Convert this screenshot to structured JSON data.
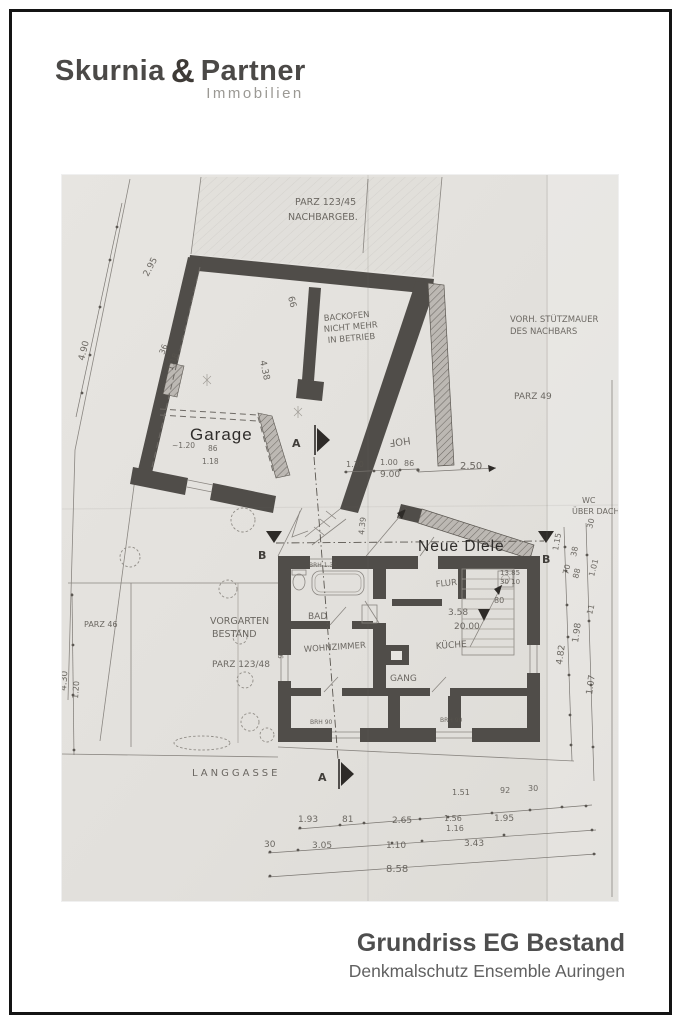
{
  "logo": {
    "name1": "Skurnia",
    "ampersand": "&",
    "name2": "Partner",
    "subtitle": "Immobilien"
  },
  "title_block": {
    "title": "Grundriss EG Bestand",
    "subtitle": "Denkmalschutz Ensemble Auringen"
  },
  "colors": {
    "wall": "#504d49",
    "paper": "#e3e1dd",
    "ink": "#57534d",
    "frame": "#141414",
    "title": "#4e4e4e"
  },
  "floorplan": {
    "labels": [
      {
        "t": "PARZ 123/45",
        "x": 233,
        "y": 30,
        "s": 9.5,
        "cls": "hand"
      },
      {
        "t": "NACHBARGEB.",
        "x": 226,
        "y": 45,
        "s": 9.5,
        "cls": "hand"
      },
      {
        "t": "2.95",
        "x": 86,
        "y": 102,
        "s": 9,
        "r": -62,
        "cls": "hand"
      },
      {
        "t": "4.90",
        "x": 22,
        "y": 186,
        "s": 9,
        "r": -76,
        "cls": "hand"
      },
      {
        "t": "36",
        "x": 102,
        "y": 180,
        "s": 8,
        "r": -68,
        "cls": "hand"
      },
      {
        "t": "1.18",
        "x": 110,
        "y": 196,
        "s": 8,
        "r": -68,
        "cls": "hand"
      },
      {
        "t": "66",
        "x": 226,
        "y": 122,
        "s": 9,
        "r": 76,
        "cls": "hand"
      },
      {
        "t": "4.38",
        "x": 198,
        "y": 186,
        "s": 9,
        "r": 78,
        "cls": "hand"
      },
      {
        "t": "BACKOFEN",
        "x": 262,
        "y": 146,
        "s": 8.5,
        "r": -5,
        "cls": "hand"
      },
      {
        "t": "NICHT MEHR",
        "x": 262,
        "y": 157,
        "s": 8.5,
        "r": -5,
        "cls": "hand"
      },
      {
        "t": "IN BETRIEB",
        "x": 266,
        "y": 168,
        "s": 8.5,
        "r": -5,
        "cls": "hand"
      },
      {
        "t": "VORH. STÜTZMAUER",
        "x": 448,
        "y": 147,
        "s": 8.5,
        "cls": "hand"
      },
      {
        "t": "DES NACHBARS",
        "x": 448,
        "y": 159,
        "s": 8.5,
        "cls": "hand"
      },
      {
        "t": "PARZ 49",
        "x": 452,
        "y": 224,
        "s": 9,
        "cls": "hand"
      },
      {
        "t": "~1.20",
        "x": 110,
        "y": 273,
        "s": 7.5,
        "cls": "hand"
      },
      {
        "t": "86",
        "x": 146,
        "y": 276,
        "s": 7.5,
        "cls": "hand"
      },
      {
        "t": "1.18",
        "x": 140,
        "y": 289,
        "s": 7.5,
        "cls": "hand"
      },
      {
        "t": "HOF",
        "x": 348,
        "y": 262,
        "s": 10,
        "r": 172,
        "cls": "hand"
      },
      {
        "t": "1.30",
        "x": 284,
        "y": 292,
        "s": 8,
        "cls": "hand"
      },
      {
        "t": "1.00",
        "x": 318,
        "y": 290,
        "s": 8,
        "cls": "hand"
      },
      {
        "t": "86",
        "x": 342,
        "y": 291,
        "s": 8,
        "cls": "hand"
      },
      {
        "t": "9.00",
        "x": 318,
        "y": 302,
        "s": 9,
        "cls": "hand"
      },
      {
        "t": "2.50",
        "x": 398,
        "y": 294,
        "s": 10,
        "cls": "hand"
      },
      {
        "t": "WC",
        "x": 520,
        "y": 328,
        "s": 8,
        "cls": "hand"
      },
      {
        "t": "ÜBER DACH",
        "x": 510,
        "y": 339,
        "s": 8,
        "cls": "hand"
      },
      {
        "t": "1.15",
        "x": 496,
        "y": 376,
        "s": 8,
        "r": -80,
        "cls": "hand"
      },
      {
        "t": "38",
        "x": 514,
        "y": 382,
        "s": 8,
        "r": -78,
        "cls": "hand"
      },
      {
        "t": "4.39",
        "x": 302,
        "y": 360,
        "s": 8,
        "r": -84,
        "cls": "hand"
      },
      {
        "t": "FLUR",
        "x": 374,
        "y": 412,
        "s": 8.5,
        "r": -6,
        "cls": "hand"
      },
      {
        "t": "BRH 1.35",
        "x": 247,
        "y": 392,
        "s": 6,
        "cls": "hand"
      },
      {
        "t": "13.85",
        "x": 438,
        "y": 400,
        "s": 7,
        "cls": "hand"
      },
      {
        "t": "30  10",
        "x": 438,
        "y": 409,
        "s": 7,
        "cls": "hand"
      },
      {
        "t": "80",
        "x": 432,
        "y": 428,
        "s": 8,
        "cls": "hand"
      },
      {
        "t": "BAD",
        "x": 246,
        "y": 444,
        "s": 9,
        "cls": "hand"
      },
      {
        "t": "3.58",
        "x": 386,
        "y": 440,
        "s": 9,
        "cls": "hand"
      },
      {
        "t": "20.00",
        "x": 392,
        "y": 454,
        "s": 9,
        "cls": "hand"
      },
      {
        "t": "KÜCHE",
        "x": 374,
        "y": 474,
        "s": 9,
        "r": -4,
        "cls": "hand"
      },
      {
        "t": "WOHNZIMMER",
        "x": 242,
        "y": 477,
        "s": 8.5,
        "r": -4,
        "cls": "hand"
      },
      {
        "t": "70",
        "x": 506,
        "y": 400,
        "s": 8,
        "r": -76,
        "cls": "hand"
      },
      {
        "t": "88",
        "x": 516,
        "y": 404,
        "s": 8,
        "r": -76,
        "cls": "hand"
      },
      {
        "t": "30",
        "x": 530,
        "y": 354,
        "s": 8,
        "r": -76,
        "cls": "hand"
      },
      {
        "t": "1.01",
        "x": 532,
        "y": 402,
        "s": 8,
        "r": -76,
        "cls": "hand"
      },
      {
        "t": "11",
        "x": 530,
        "y": 440,
        "s": 8,
        "r": -76,
        "cls": "hand"
      },
      {
        "t": "1.98",
        "x": 516,
        "y": 468,
        "s": 9,
        "r": -82,
        "cls": "hand"
      },
      {
        "t": "4.82",
        "x": 500,
        "y": 490,
        "s": 9,
        "r": -82,
        "cls": "hand"
      },
      {
        "t": "1.07",
        "x": 530,
        "y": 520,
        "s": 9,
        "r": -82,
        "cls": "hand"
      },
      {
        "t": "VORGARTEN",
        "x": 148,
        "y": 449,
        "s": 9.5,
        "cls": "hand"
      },
      {
        "t": "BESTAND",
        "x": 150,
        "y": 462,
        "s": 9.5,
        "cls": "hand"
      },
      {
        "t": "PARZ 123/48",
        "x": 150,
        "y": 492,
        "s": 9,
        "cls": "hand"
      },
      {
        "t": "PARZ 46",
        "x": 22,
        "y": 452,
        "s": 8,
        "cls": "hand"
      },
      {
        "t": "4.30",
        "x": 4,
        "y": 516,
        "s": 9,
        "r": -86,
        "cls": "hand"
      },
      {
        "t": "1.20",
        "x": 16,
        "y": 524,
        "s": 8,
        "r": -86,
        "cls": "hand"
      },
      {
        "t": "90",
        "x": 221,
        "y": 484,
        "s": 7,
        "r": -84,
        "cls": "hand"
      },
      {
        "t": "GANG",
        "x": 328,
        "y": 506,
        "s": 9,
        "cls": "hand"
      },
      {
        "t": "BRH 90",
        "x": 248,
        "y": 549,
        "s": 6,
        "cls": "hand"
      },
      {
        "t": "BRH 90",
        "x": 378,
        "y": 547,
        "s": 6,
        "cls": "hand"
      },
      {
        "t": "LANGGASSE",
        "x": 130,
        "y": 601,
        "s": 10,
        "ls": 3,
        "cls": "hand"
      },
      {
        "t": "1.51",
        "x": 390,
        "y": 620,
        "s": 8,
        "cls": "hand"
      },
      {
        "t": "92",
        "x": 438,
        "y": 618,
        "s": 8,
        "cls": "hand"
      },
      {
        "t": "30",
        "x": 466,
        "y": 616,
        "s": 8,
        "cls": "hand"
      },
      {
        "t": "1.93",
        "x": 236,
        "y": 647,
        "s": 9,
        "cls": "hand"
      },
      {
        "t": "81",
        "x": 280,
        "y": 647,
        "s": 9,
        "cls": "hand"
      },
      {
        "t": "2.65",
        "x": 330,
        "y": 648,
        "s": 9,
        "cls": "hand"
      },
      {
        "t": "1.56",
        "x": 382,
        "y": 646,
        "s": 8,
        "cls": "hand"
      },
      {
        "t": "1.16",
        "x": 384,
        "y": 656,
        "s": 8,
        "cls": "hand"
      },
      {
        "t": "1.95",
        "x": 432,
        "y": 646,
        "s": 9,
        "cls": "hand"
      },
      {
        "t": "30",
        "x": 202,
        "y": 672,
        "s": 9,
        "cls": "hand"
      },
      {
        "t": "3.05",
        "x": 250,
        "y": 673,
        "s": 9,
        "cls": "hand"
      },
      {
        "t": "1.10",
        "x": 324,
        "y": 673,
        "s": 9,
        "cls": "hand"
      },
      {
        "t": "3.43",
        "x": 402,
        "y": 671,
        "s": 9,
        "cls": "hand"
      },
      {
        "t": "8.58",
        "x": 324,
        "y": 697,
        "s": 10,
        "cls": "hand"
      },
      {
        "t": "A",
        "x": 230,
        "y": 272,
        "s": 11,
        "cls": "marker"
      },
      {
        "t": "A",
        "x": 256,
        "y": 606,
        "s": 11,
        "cls": "marker"
      },
      {
        "t": "B",
        "x": 196,
        "y": 384,
        "s": 11,
        "cls": "marker"
      },
      {
        "t": "B",
        "x": 480,
        "y": 388,
        "s": 11,
        "cls": "marker"
      },
      {
        "t": "Garage",
        "x": 128,
        "y": 265,
        "s": 17,
        "cls": "printed"
      },
      {
        "t": "Neue Diele",
        "x": 356,
        "y": 376,
        "s": 15.5,
        "cls": "printed"
      }
    ]
  }
}
